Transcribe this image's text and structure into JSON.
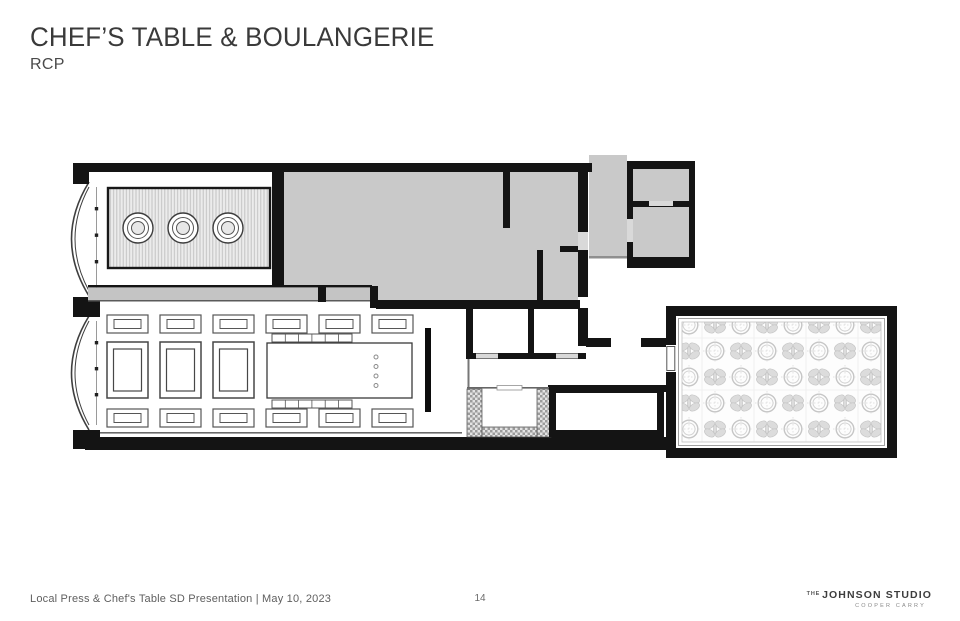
{
  "slide": {
    "title": "CHEF’S TABLE & BOULANGERIE",
    "subtitle": "RCP"
  },
  "footer": {
    "left_text": "Local Press & Chef's Table SD Presentation | May 10, 2023",
    "page_number": "14",
    "logo": {
      "prefix": "THE",
      "name": "JOHNSON STUDIO",
      "subname": "COOPER CARRY"
    }
  },
  "plan": {
    "type": "reflected-ceiling-plan",
    "colors": {
      "wall": "#141414",
      "room-fill": "#c9c9c9",
      "panel-stripe": "#c2c2c2",
      "ornate": "#c6c6c6"
    }
  }
}
